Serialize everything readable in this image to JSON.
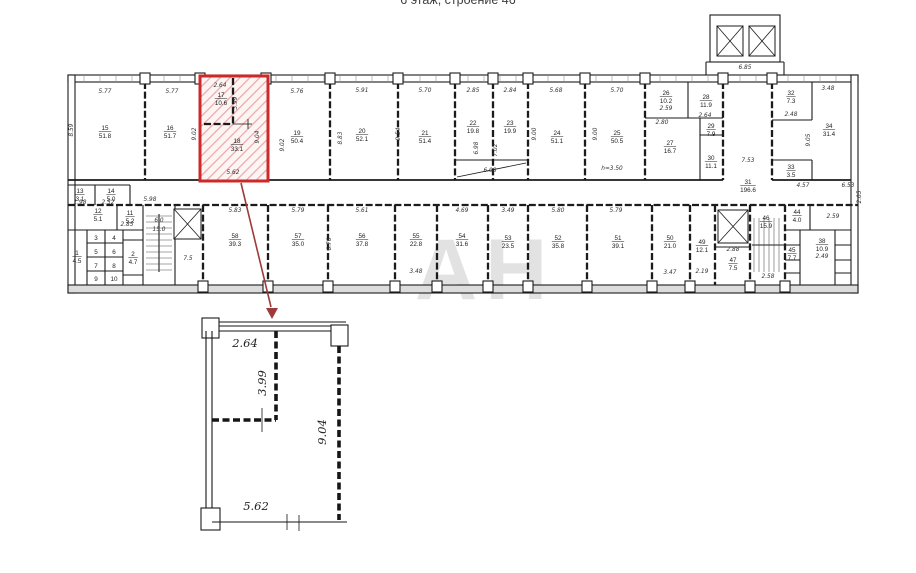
{
  "title": "6 этаж, строение 46",
  "watermark": "АН",
  "colors": {
    "highlight": "#cc2a2a",
    "highlight_hatch": "#e8a8a8",
    "arrow": "#9e3a3a",
    "watermark": "#c6c6c6"
  },
  "plan": {
    "rooms": [
      {
        "n": "17",
        "a": "10.6",
        "x": 221,
        "y": 97
      },
      {
        "n": "18",
        "a": "33.1",
        "x": 237,
        "y": 143
      },
      {
        "n": "15",
        "a": "51.8",
        "x": 105,
        "y": 130
      },
      {
        "n": "16",
        "a": "51.7",
        "x": 170,
        "y": 130
      },
      {
        "n": "19",
        "a": "50.4",
        "x": 297,
        "y": 135
      },
      {
        "n": "20",
        "a": "52.1",
        "x": 362,
        "y": 133
      },
      {
        "n": "21",
        "a": "51.4",
        "x": 425,
        "y": 135
      },
      {
        "n": "22",
        "a": "19.8",
        "x": 473,
        "y": 125
      },
      {
        "n": "23",
        "a": "19.9",
        "x": 510,
        "y": 125
      },
      {
        "n": "24",
        "a": "51.1",
        "x": 557,
        "y": 135
      },
      {
        "n": "25",
        "a": "50.5",
        "x": 617,
        "y": 135
      },
      {
        "n": "26",
        "a": "10.2",
        "x": 666,
        "y": 95
      },
      {
        "n": "28",
        "a": "11.9",
        "x": 706,
        "y": 99
      },
      {
        "n": "29",
        "a": "7.9",
        "x": 711,
        "y": 128
      },
      {
        "n": "27",
        "a": "16.7",
        "x": 670,
        "y": 145
      },
      {
        "n": "30",
        "a": "11.1",
        "x": 711,
        "y": 160
      },
      {
        "n": "31",
        "a": "196.6",
        "x": 748,
        "y": 184
      },
      {
        "n": "32",
        "a": "7.3",
        "x": 791,
        "y": 95
      },
      {
        "n": "33",
        "a": "3.5",
        "x": 791,
        "y": 169
      },
      {
        "n": "34",
        "a": "31.4",
        "x": 829,
        "y": 128
      },
      {
        "n": "13",
        "a": "3.1",
        "x": 80,
        "y": 193
      },
      {
        "n": "14",
        "a": "5.0",
        "x": 111,
        "y": 193
      },
      {
        "n": "12",
        "a": "5.1",
        "x": 98,
        "y": 213
      },
      {
        "n": "11",
        "a": "5.2",
        "x": 130,
        "y": 215
      },
      {
        "n": "1",
        "a": "4.5",
        "x": 77,
        "y": 255
      },
      {
        "n": "2",
        "a": "4.7",
        "x": 133,
        "y": 256
      },
      {
        "n": "3",
        "x": 96,
        "y": 240
      },
      {
        "n": "4",
        "x": 114,
        "y": 240
      },
      {
        "n": "5",
        "x": 96,
        "y": 254
      },
      {
        "n": "6",
        "x": 114,
        "y": 254
      },
      {
        "n": "7",
        "x": 96,
        "y": 268
      },
      {
        "n": "8",
        "x": 114,
        "y": 268
      },
      {
        "n": "9",
        "x": 96,
        "y": 281
      },
      {
        "n": "10",
        "x": 114,
        "y": 281
      },
      {
        "n": "58",
        "a": "39.3",
        "x": 235,
        "y": 238
      },
      {
        "n": "57",
        "a": "35.0",
        "x": 298,
        "y": 238
      },
      {
        "n": "56",
        "a": "37.8",
        "x": 362,
        "y": 238
      },
      {
        "n": "55",
        "a": "22.8",
        "x": 416,
        "y": 238
      },
      {
        "n": "54",
        "a": "31.6",
        "x": 462,
        "y": 238
      },
      {
        "n": "53",
        "a": "23.5",
        "x": 508,
        "y": 240
      },
      {
        "n": "52",
        "a": "35.8",
        "x": 558,
        "y": 240
      },
      {
        "n": "51",
        "a": "39.1",
        "x": 618,
        "y": 240
      },
      {
        "n": "50",
        "a": "21.0",
        "x": 670,
        "y": 240
      },
      {
        "n": "49",
        "a": "12.1",
        "x": 702,
        "y": 244
      },
      {
        "n": "46",
        "a": "15.9",
        "x": 766,
        "y": 220
      },
      {
        "n": "47",
        "a": "7.5",
        "x": 733,
        "y": 262
      },
      {
        "n": "45",
        "a": "7.7",
        "x": 792,
        "y": 252
      },
      {
        "n": "44",
        "a": "4.0",
        "x": 797,
        "y": 214
      },
      {
        "n": "38",
        "a": "10.9",
        "x": 822,
        "y": 243
      }
    ],
    "dims": [
      {
        "t": "5.77",
        "x": 105,
        "y": 93
      },
      {
        "t": "5.77",
        "x": 172,
        "y": 93
      },
      {
        "t": "2.64",
        "x": 220,
        "y": 87
      },
      {
        "t": "3.99",
        "x": 237,
        "y": 103,
        "r": 1
      },
      {
        "t": "9.04",
        "x": 259,
        "y": 137,
        "r": 1
      },
      {
        "t": "5.62",
        "x": 233,
        "y": 174
      },
      {
        "t": "5.76",
        "x": 297,
        "y": 93
      },
      {
        "t": "5.91",
        "x": 362,
        "y": 92
      },
      {
        "t": "5.70",
        "x": 425,
        "y": 92
      },
      {
        "t": "2.85",
        "x": 473,
        "y": 92
      },
      {
        "t": "2.84",
        "x": 510,
        "y": 92
      },
      {
        "t": "5.68",
        "x": 556,
        "y": 92
      },
      {
        "t": "5.70",
        "x": 617,
        "y": 92
      },
      {
        "t": "6.85",
        "x": 745,
        "y": 69
      },
      {
        "t": "3.48",
        "x": 828,
        "y": 90
      },
      {
        "t": "2.48",
        "x": 791,
        "y": 116
      },
      {
        "t": "2.59",
        "x": 666,
        "y": 110
      },
      {
        "t": "2.80",
        "x": 662,
        "y": 124
      },
      {
        "t": "2.64",
        "x": 705,
        "y": 117
      },
      {
        "t": "8.59",
        "x": 73,
        "y": 130,
        "r": 1
      },
      {
        "t": "9.02",
        "x": 196,
        "y": 134,
        "r": 1
      },
      {
        "t": "9.02",
        "x": 284,
        "y": 145,
        "r": 1
      },
      {
        "t": "8.83",
        "x": 342,
        "y": 138,
        "r": 1
      },
      {
        "t": "9.54",
        "x": 400,
        "y": 134,
        "r": 1
      },
      {
        "t": "6.98",
        "x": 478,
        "y": 148,
        "r": 1
      },
      {
        "t": "7.02",
        "x": 497,
        "y": 150,
        "r": 1
      },
      {
        "t": "9.00",
        "x": 536,
        "y": 134,
        "r": 1
      },
      {
        "t": "9.00",
        "x": 597,
        "y": 134,
        "r": 1
      },
      {
        "t": "9.05",
        "x": 810,
        "y": 140,
        "r": 1
      },
      {
        "t": "h=3.50",
        "x": 612,
        "y": 170
      },
      {
        "t": "6.08",
        "x": 490,
        "y": 172
      },
      {
        "t": "7.53",
        "x": 748,
        "y": 162
      },
      {
        "t": "4.57",
        "x": 803,
        "y": 187
      },
      {
        "t": "6.53",
        "x": 848,
        "y": 187
      },
      {
        "t": "2.05",
        "x": 861,
        "y": 197,
        "r": 1
      },
      {
        "t": "5.98",
        "x": 150,
        "y": 201
      },
      {
        "t": "1.98",
        "x": 80,
        "y": 204
      },
      {
        "t": "2.52",
        "x": 108,
        "y": 204
      },
      {
        "t": "2.85",
        "x": 127,
        "y": 226
      },
      {
        "t": "6.0",
        "x": 159,
        "y": 222
      },
      {
        "t": "15.0",
        "x": 159,
        "y": 231
      },
      {
        "t": "7.5",
        "x": 188,
        "y": 260
      },
      {
        "t": "5.83",
        "x": 235,
        "y": 212
      },
      {
        "t": "5.79",
        "x": 298,
        "y": 212
      },
      {
        "t": "5.61",
        "x": 362,
        "y": 212
      },
      {
        "t": "4.69",
        "x": 462,
        "y": 212
      },
      {
        "t": "3.49",
        "x": 508,
        "y": 212
      },
      {
        "t": "5.80",
        "x": 558,
        "y": 212
      },
      {
        "t": "5.79",
        "x": 616,
        "y": 212
      },
      {
        "t": "6.76",
        "x": 331,
        "y": 244,
        "r": 1
      },
      {
        "t": "3.48",
        "x": 416,
        "y": 273
      },
      {
        "t": "3.47",
        "x": 670,
        "y": 274
      },
      {
        "t": "2.19",
        "x": 702,
        "y": 273
      },
      {
        "t": "2.88",
        "x": 733,
        "y": 251
      },
      {
        "t": "2.58",
        "x": 768,
        "y": 278
      },
      {
        "t": "2.59",
        "x": 833,
        "y": 218
      },
      {
        "t": "2.49",
        "x": 822,
        "y": 258
      }
    ]
  },
  "detail": {
    "dims": [
      {
        "t": "2.64",
        "x": 245,
        "y": 347
      },
      {
        "t": "3.99",
        "x": 266,
        "y": 383,
        "r": 1
      },
      {
        "t": "9.04",
        "x": 326,
        "y": 432,
        "r": 1
      },
      {
        "t": "5.62",
        "x": 256,
        "y": 510
      }
    ]
  }
}
